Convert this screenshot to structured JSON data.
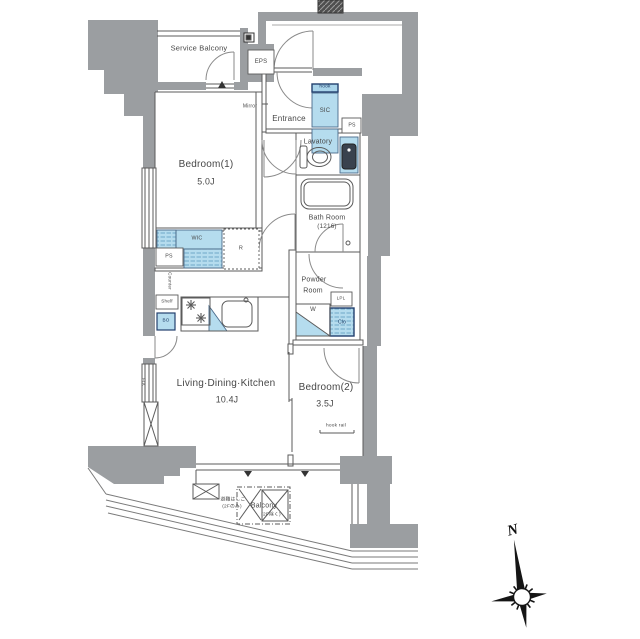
{
  "labels": {
    "service_balcony": "Service Balcony",
    "eps": "EPS",
    "entrance": "Entrance",
    "mirror": "Mirror",
    "sic": "SIC",
    "sic_hook": "hook",
    "ps_upper": "PS",
    "lavatory": "Lavatory",
    "bath_room": "Bath Room",
    "bath_size": "(1216)",
    "bedroom1": "Bedroom(1)",
    "bedroom1_size": "5.0J",
    "wic": "WIC",
    "ps_lower": "PS",
    "refrigerator": "R",
    "powder_1": "Powder",
    "powder_2": "Room",
    "washer": "W",
    "upl": "LPL",
    "closet": "Clo",
    "shelf": "Shelf",
    "bottle": "BO",
    "counter": "Counter",
    "fix": "FIX",
    "ldk": "Living·Dining·Kitchen",
    "ldk_size": "10.4J",
    "bedroom2": "Bedroom(2)",
    "bedroom2_size": "3.5J",
    "hook_rail": "hook rail",
    "balcony": "Balcony",
    "balcony_note": "(2F除く)",
    "ladder_1": "避難はしご",
    "ladder_2": "(2Fのみ)",
    "north": "N"
  },
  "colors": {
    "wall": "#9b9ea1",
    "storage_fill": "#b5dcee",
    "line": "#555555",
    "dark_navy": "#23406e"
  }
}
